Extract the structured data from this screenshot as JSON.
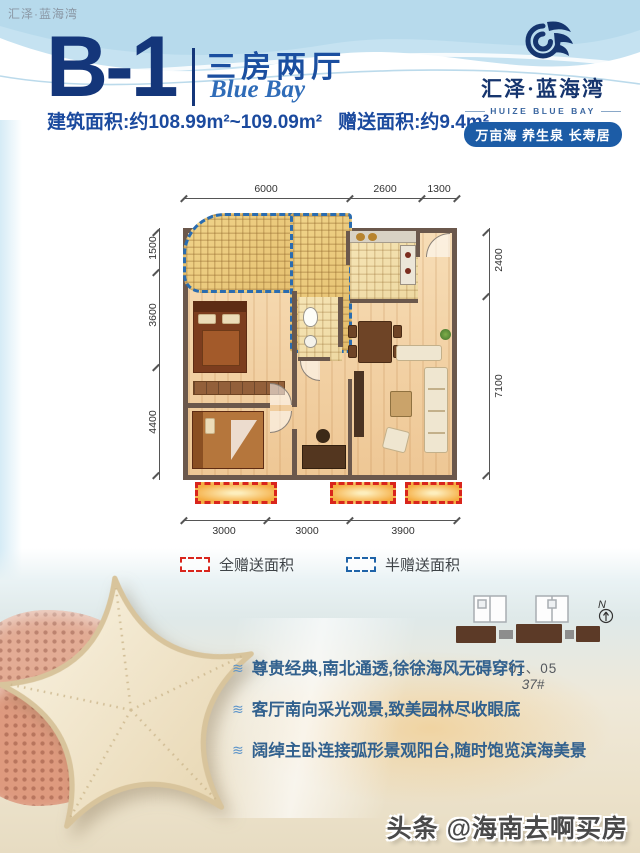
{
  "page": {
    "brand_top_left": "汇泽·蓝海湾"
  },
  "header": {
    "unit_code": "B-1",
    "unit_type_cn": "三房两厅",
    "unit_type_en": "Blue Bay",
    "area_build": "建筑面积:约108.99m²~109.09m²",
    "area_gift": "赠送面积:约9.4m²"
  },
  "logo": {
    "name_cn": "汇泽·蓝海湾",
    "name_en": "HUIZE BLUE BAY",
    "slogan": "万亩海 养生泉 长寿居"
  },
  "floorplan": {
    "dims_top": [
      "6000",
      "2600",
      "1300"
    ],
    "dims_bottom": [
      "3000",
      "3000",
      "3900"
    ],
    "dims_left": [
      "1500",
      "3600",
      "4400"
    ],
    "dims_right": [
      "2400",
      "7100"
    ]
  },
  "legend": {
    "full_gift": {
      "label": "全赠送面积",
      "color": "#d9251c"
    },
    "half_gift": {
      "label": "半赠送面积",
      "color": "#1e63a8"
    }
  },
  "site_plan": {
    "units": "01、05",
    "building": "37#",
    "north": "N"
  },
  "features": [
    "尊贵经典,南北通透,徐徐海风无碍穿行",
    "客厅南向采光观景,致美园林尽收眼底",
    "阔绰主卧连接弧形景观阳台,随时饱览滨海美景"
  ],
  "watermark": "头条 @海南去啊买房",
  "colors": {
    "primary_blue": "#14367a",
    "accent_blue": "#1c5ca6",
    "legend_red": "#d9251c",
    "legend_blue": "#1e63a8",
    "wall_brown": "#6b584c"
  }
}
